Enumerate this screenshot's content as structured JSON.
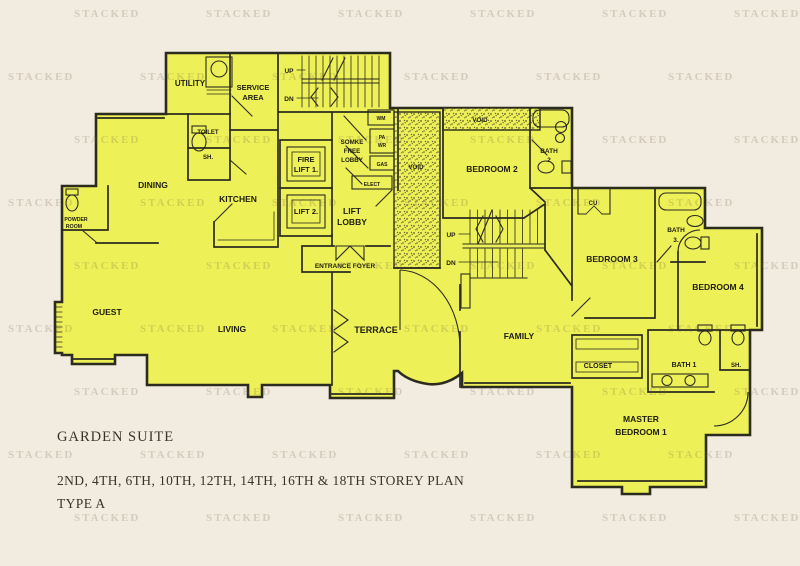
{
  "colors": {
    "background": "#f2ebdf",
    "unit_fill": "#eef058",
    "line": "#2b2b1e",
    "footer_text": "#39332a"
  },
  "watermark": {
    "text": "STACKED"
  },
  "plan": {
    "labels": {
      "utility": "UTILITY",
      "service_area": [
        "SERVICE",
        "AREA"
      ],
      "stairs_service": {
        "up": "UP",
        "dn": "DN"
      },
      "toilet": "TOILET",
      "toilet_shower": "SH.",
      "dining": "DINING",
      "kitchen": "KITCHEN",
      "fire_lift": [
        "FIRE",
        "LIFT 1."
      ],
      "lift2": "LIFT 2.",
      "smoke_free_lobby": [
        "SOMKE",
        "FREE",
        "LOBBY"
      ],
      "lift_lobby": [
        "LIFT",
        "LOBBY"
      ],
      "risers": {
        "wm": "WM",
        "pa_wr": [
          "PA",
          "WR"
        ],
        "gas": "GAS",
        "elect": "ELECT"
      },
      "void_main": "VOID",
      "void_strip": "VOID",
      "bedroom2": "BEDROOM 2",
      "bath2": [
        "BATH",
        "2"
      ],
      "entrance_foyer": "ENTRANCE FOYER",
      "stairs_internal": {
        "up": "UP",
        "dn": "DN"
      },
      "cu": "CU",
      "bedroom3": "BEDROOM 3",
      "bath3": [
        "BATH",
        "3."
      ],
      "bedroom4": "BEDROOM 4",
      "powder_room": [
        "POWDER",
        "ROOM"
      ],
      "guest": "GUEST",
      "living": "LIVING",
      "terrace": "TERRACE",
      "family": "FAMILY",
      "closet": "CLOSET",
      "bath1": "BATH 1",
      "shower_master": "SH.",
      "master_bedroom": [
        "MASTER",
        "BEDROOM 1"
      ]
    }
  },
  "footer": {
    "title": "GARDEN SUITE",
    "storey_line": "2ND, 4TH, 6TH, 10TH, 12TH, 14TH, 16TH & 18TH STOREY PLAN",
    "type_line": "TYPE A"
  }
}
